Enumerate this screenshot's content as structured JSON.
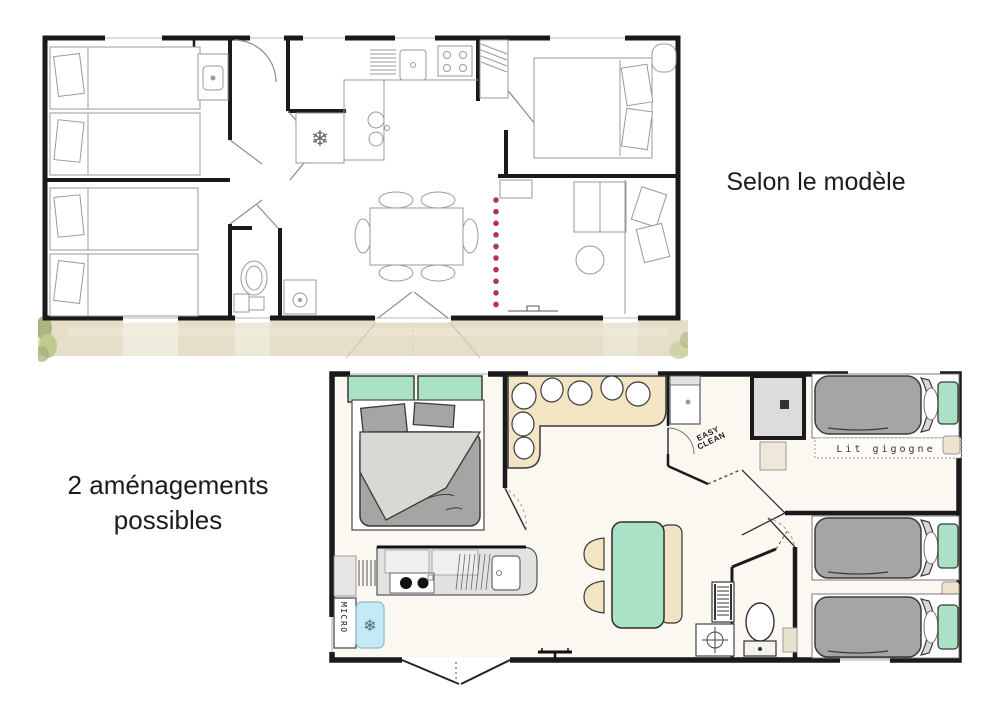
{
  "captions": {
    "selon_le_modele": "Selon le modèle",
    "amenagements_line1": "2 aménagements",
    "amenagements_line2": "possibles"
  },
  "plan_top": {
    "description": "line-art mobile-home floorplan with terrace strip",
    "fridge_icon": "❄"
  },
  "plan_bottom": {
    "description": "colored mobile-home floorplan, 3 bedrooms",
    "labels": {
      "lit_gigogne": "Lit gigogne",
      "easy_line1": "EASY",
      "easy_line2": "CLEAN",
      "micro": "MICRO"
    },
    "fridge_icon": "❄"
  },
  "colors": {
    "wall": "#1a1a1a",
    "line_gray": "#9a9a9a",
    "text_dark": "#1c1c1c",
    "mint": "#abe2c7",
    "beige": "#f3e5c3",
    "duvet_gray": "#a5a5a3",
    "blanket_gray": "#d8d8d5",
    "fridge_blue": "#c5eaf5",
    "snowflake_blue": "#46707f",
    "red_dots": "#b13354",
    "terrace": "#e5dfca",
    "grass": "#a4ad74",
    "floor_cream": "#fbf8f1"
  }
}
